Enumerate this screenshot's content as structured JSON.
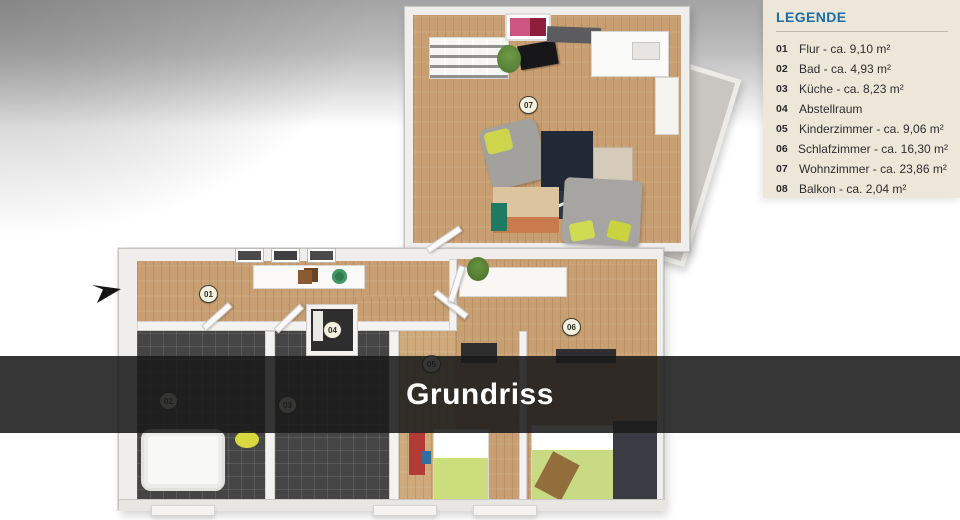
{
  "overlay": {
    "title": "Grundriss"
  },
  "legend": {
    "header": "LEGENDE",
    "items": [
      {
        "num": "01",
        "label": "Flur - ca. 9,10 m²"
      },
      {
        "num": "02",
        "label": "Bad - ca. 4,93 m²"
      },
      {
        "num": "03",
        "label": "Küche - ca. 8,23 m²"
      },
      {
        "num": "04",
        "label": "Abstellraum"
      },
      {
        "num": "05",
        "label": "Kinderzimmer - ca. 9,06 m²"
      },
      {
        "num": "06",
        "label": "Schlafzimmer - ca. 16,30 m²"
      },
      {
        "num": "07",
        "label": "Wohnzimmer - ca. 23,86 m²"
      },
      {
        "num": "08",
        "label": "Balkon - ca. 2,04 m²"
      }
    ]
  },
  "floorplan": {
    "markers": [
      {
        "num": "01",
        "room": "Flur"
      },
      {
        "num": "02",
        "room": "Bad"
      },
      {
        "num": "03",
        "room": "Küche"
      },
      {
        "num": "04",
        "room": "Abstellraum"
      },
      {
        "num": "05",
        "room": "Kinderzimmer"
      },
      {
        "num": "06",
        "room": "Schlafzimmer"
      },
      {
        "num": "07",
        "room": "Wohnzimmer"
      }
    ]
  },
  "colors": {
    "legend_header": "#1a6da8",
    "legend_bg": "#ece7d9",
    "overlay_band": "rgba(26,26,26,0.88)",
    "wood_floor": "#c79f72",
    "dark_tile": "#454545"
  }
}
